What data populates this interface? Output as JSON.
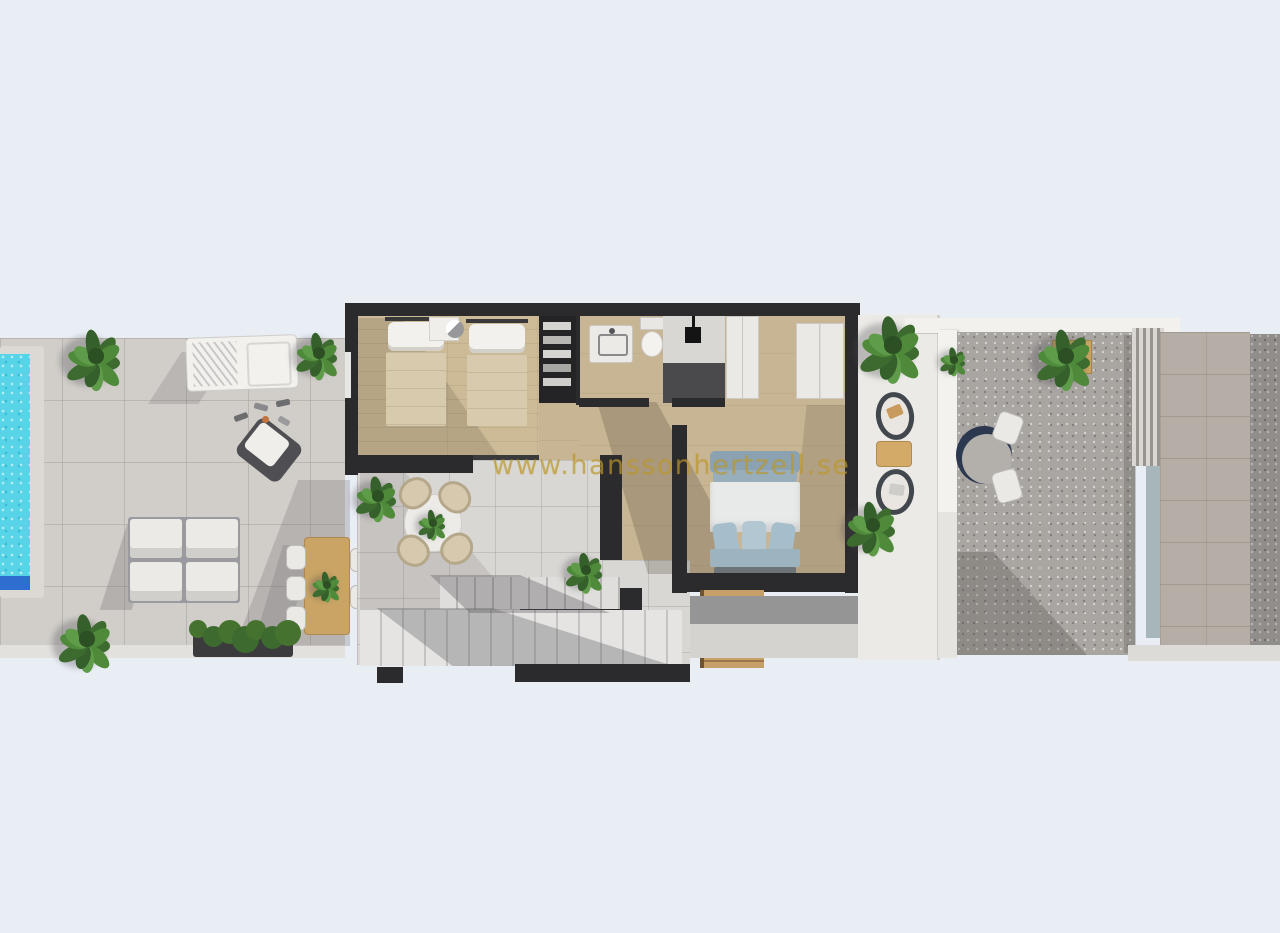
{
  "watermark": {
    "text": "www.hanssonhertzell.se",
    "color": "#bb982a"
  },
  "palette": {
    "background": "#e9edf4",
    "building_wall": "#2b2a2c",
    "deck_tile": "#d1cec9",
    "bedroom_wood_floor": "#cdbb98",
    "corridor_floor": "#c8b593",
    "terrace_tile": "#d9d7d4",
    "pool_water": "#57d4e8",
    "pool_step_blue": "#2f6ed0",
    "gravel_terrace": "#a9a5a1",
    "stone_wall": "#b4aea6",
    "wood_furniture": "#c9a465",
    "master_bedding_blue": "#9db4c0",
    "plant_green": "#4f8a3b",
    "white_furniture": "#f2f1ee",
    "shower_floor": "#4a4a4d"
  }
}
